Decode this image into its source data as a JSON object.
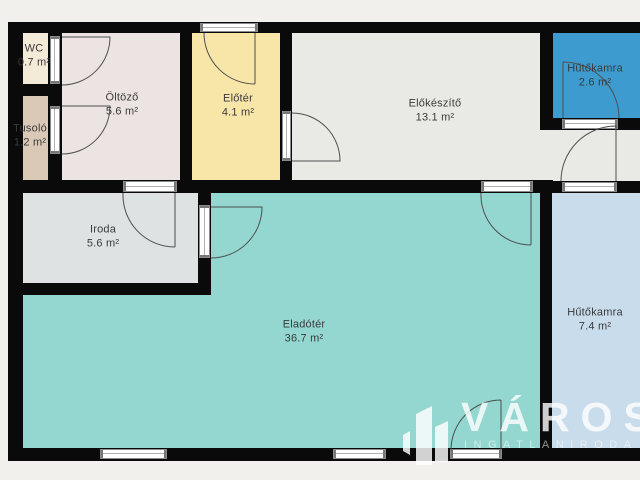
{
  "plan": {
    "background": "#f1f0ec",
    "wall_color": "#0a0a0a",
    "label_color": "#3a3a3a",
    "rooms": [
      {
        "name": "wc",
        "label": "WC",
        "area": "0.7 m²",
        "color": "#f3ead8",
        "rect": [
          23,
          33,
          25,
          51
        ],
        "label_at": [
          34,
          56
        ]
      },
      {
        "name": "tusolo",
        "label": "Tusoló",
        "area": "1.2 m²",
        "color": "#dbc9b8",
        "rect": [
          23,
          96,
          25,
          84
        ],
        "label_at": [
          30,
          136
        ]
      },
      {
        "name": "oltozo",
        "label": "Öltöző",
        "area": "5.6 m²",
        "color": "#ece4e3",
        "rect": [
          62,
          33,
          118,
          147
        ],
        "label_at": [
          122,
          105
        ]
      },
      {
        "name": "eloter",
        "label": "Előtér",
        "area": "4.1 m²",
        "color": "#f8e6a9",
        "rect": [
          192,
          33,
          88,
          147
        ],
        "label_at": [
          238,
          106
        ]
      },
      {
        "name": "elokeszito",
        "label": "Előkészítő",
        "area": "13.1 m²",
        "color": "#e9e9e5",
        "rect": [
          292,
          33,
          248,
          147
        ],
        "label_at": [
          435,
          111
        ]
      },
      {
        "name": "elokeszito-ext",
        "label": "",
        "area": "",
        "color": "#e9e9e5",
        "rect": [
          540,
          130,
          100,
          51
        ],
        "label_at": null
      },
      {
        "name": "hutokamra-kis",
        "label": "Hűtőkamra",
        "area": "2.6 m²",
        "color": "#3e9bcf",
        "rect": [
          553,
          33,
          87,
          85
        ],
        "label_at": [
          595,
          76
        ]
      },
      {
        "name": "iroda",
        "label": "Iroda",
        "area": "5.6 m²",
        "color": "#dee2e2",
        "rect": [
          23,
          193,
          175,
          90
        ],
        "label_at": [
          103,
          237
        ]
      },
      {
        "name": "eladoter",
        "label": "Eladótér",
        "area": "36.7 m²",
        "color": "#93d7d0",
        "rect": [
          211,
          193,
          329,
          255
        ],
        "label_at": [
          304,
          332
        ]
      },
      {
        "name": "eladoter-ext",
        "label": "",
        "area": "",
        "color": "#93d7d0",
        "rect": [
          23,
          295,
          188,
          153
        ],
        "label_at": null
      },
      {
        "name": "hutokamra-nagy",
        "label": "Hűtőkamra",
        "area": "7.4 m²",
        "color": "#c9dcec",
        "rect": [
          552,
          193,
          88,
          255
        ],
        "label_at": [
          595,
          320
        ]
      }
    ],
    "walls": [
      [
        8,
        22,
        632,
        11
      ],
      [
        8,
        22,
        15,
        439
      ],
      [
        8,
        448,
        632,
        13
      ],
      [
        48,
        33,
        14,
        147
      ],
      [
        23,
        84,
        25,
        12
      ],
      [
        180,
        33,
        12,
        147
      ],
      [
        280,
        33,
        12,
        147
      ],
      [
        8,
        180,
        545,
        13
      ],
      [
        198,
        193,
        13,
        102
      ],
      [
        8,
        283,
        203,
        12
      ],
      [
        540,
        22,
        13,
        108
      ],
      [
        540,
        118,
        100,
        12
      ],
      [
        553,
        181,
        87,
        12
      ],
      [
        540,
        181,
        12,
        279
      ]
    ],
    "openings": [
      {
        "name": "entrance-door-top",
        "rect": [
          200,
          23,
          58,
          9
        ]
      },
      {
        "name": "wc-door",
        "rect": [
          50,
          36,
          10,
          48
        ]
      },
      {
        "name": "tusolo-door",
        "rect": [
          50,
          106,
          10,
          48
        ]
      },
      {
        "name": "eloter-elokeszito-door",
        "rect": [
          282,
          111,
          9,
          50
        ]
      },
      {
        "name": "oltozo-iroda-door",
        "rect": [
          123,
          181,
          54,
          11
        ]
      },
      {
        "name": "iroda-eladoter-door",
        "rect": [
          199,
          205,
          11,
          53
        ]
      },
      {
        "name": "elokeszito-eladoter-door",
        "rect": [
          481,
          181,
          52,
          11
        ]
      },
      {
        "name": "hutokamra-kis-door",
        "rect": [
          562,
          119,
          56,
          10
        ]
      },
      {
        "name": "hutokamra-nagy-door",
        "rect": [
          562,
          182,
          55,
          10
        ]
      },
      {
        "name": "entrance-door-bottom",
        "rect": [
          450,
          449,
          52,
          10
        ]
      },
      {
        "name": "window-left",
        "rect": [
          100,
          449,
          67,
          10
        ]
      },
      {
        "name": "window-mid",
        "rect": [
          333,
          449,
          53,
          10
        ]
      }
    ],
    "door_arcs": [
      {
        "name": "wc-door-arc",
        "path": "M 62 37 L 110 37 A 48 48 0 0 1 62 85"
      },
      {
        "name": "tusolo-door-arc",
        "path": "M 62 106 L 110 106 A 48 48 0 0 1 62 154"
      },
      {
        "name": "entrance-top-arc",
        "path": "M 255 33 L 255 84 M 204 33 A 51 51 0 0 0 255 84"
      },
      {
        "name": "eloter-elokeszito-arc",
        "path": "M 292 161 L 340 161 A 48 48 0 0 0 292 113"
      },
      {
        "name": "oltozo-iroda-arc",
        "path": "M 175 193 L 175 247 M 123 193 A 52 52 0 0 0 175 247"
      },
      {
        "name": "iroda-eladoter-arc",
        "path": "M 211 207 L 262 207 A 51 51 0 0 1 211 258"
      },
      {
        "name": "elokeszito-eladoter-arc",
        "path": "M 531 193 L 531 245 M 481 193 A 50 50 0 0 0 531 245"
      },
      {
        "name": "hutokamra-kis-arc",
        "path": "M 563 118 L 563 62 A 56 56 0 0 1 619 118"
      },
      {
        "name": "hutokamra-nagy-arc",
        "path": "M 616 181 L 616 126 A 55 55 0 0 0 561 181"
      },
      {
        "name": "entrance-bottom-arc",
        "path": "M 501 450 L 501 400 M 451 450 A 50 50 0 0 1 501 400"
      }
    ],
    "logo": {
      "title": "VÁROSI",
      "subtitle": "INGATLANIRODA",
      "color": "#ffffff"
    }
  }
}
